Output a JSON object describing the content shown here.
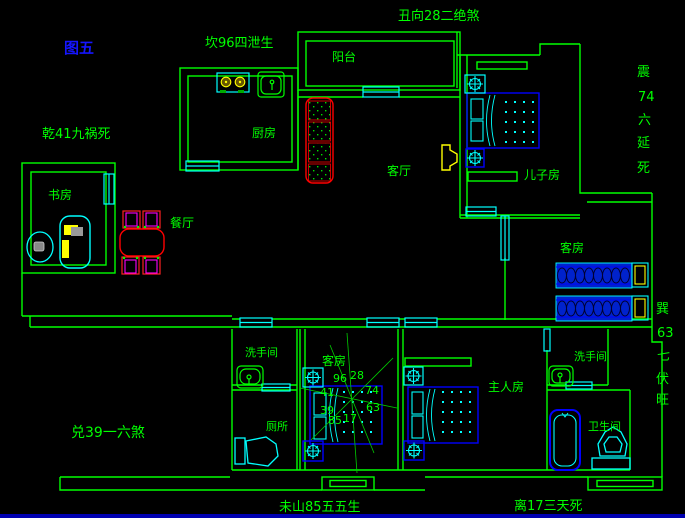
{
  "figure_label": "图五",
  "fengshui": {
    "top_center": "丑向28二绝煞",
    "top_left": "坎96四泄生",
    "left_upper": "乾41九祸死",
    "left_lower": "兑39一六煞",
    "bottom_left": "未山85五五生",
    "bottom_right": "离17三天死",
    "right_upper": [
      "震",
      "74",
      "六",
      "延",
      "死"
    ],
    "right_lower": [
      "巽",
      "63",
      "七",
      "伏",
      "旺"
    ]
  },
  "rooms": {
    "balcony": "阳台",
    "kitchen": "厨房",
    "study": "书房",
    "dining": "餐厅",
    "living": "客厅",
    "son_bedroom": "儿子房",
    "guest_bedroom_east": "客房",
    "guest_bedroom_center": "客房",
    "master_bedroom": "主人房",
    "washroom_west": "洗手间",
    "toilet_west": "厕所",
    "washroom_east": "洗手间",
    "bathroom_east": "卫生间"
  },
  "compass": {
    "numbers": {
      "top_left": "96",
      "top_right": "28",
      "left_upper": "41",
      "right_upper": "74",
      "left_lower": "39",
      "right_lower": "63",
      "bottom_left": "85",
      "bottom_right": "17"
    }
  },
  "colors": {
    "background": "#000000",
    "wall": "#00ff00",
    "window_door": "#00ffff",
    "bed": "#0000ff",
    "accent_red": "#ff0000",
    "accent_magenta": "#ff00ff",
    "accent_yellow": "#ffff00",
    "figure_label_blue": "#1515ff",
    "bottom_bar_blue": "#0000b0"
  }
}
